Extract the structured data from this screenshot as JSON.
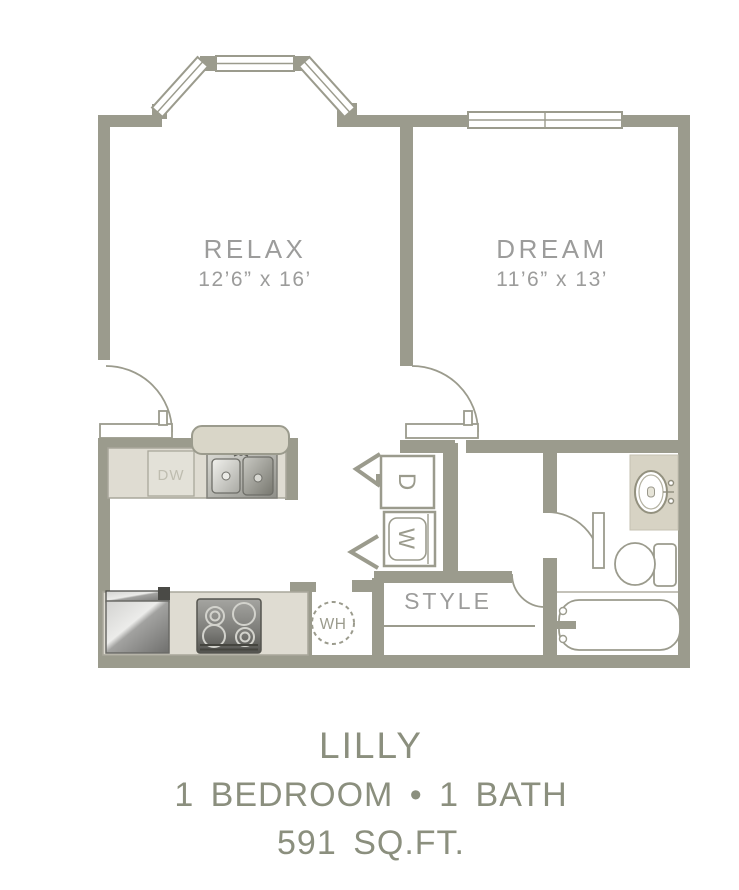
{
  "colors": {
    "wall": "#9B9B8D",
    "counterFill": "#DFDCD2",
    "counterStroke": "#A9A79B",
    "barFill": "#D9D6C8",
    "dwFill": "#E3E1D8",
    "dwText": "#BFBDB0",
    "vanityFill": "#D7D3C4",
    "labelGray": "#9C9C9B",
    "titleColor": "#8B8F7E"
  },
  "rooms": {
    "living": {
      "label": "RELAX",
      "dims": "12’6” x 16’"
    },
    "bedroom": {
      "label": "DREAM",
      "dims": "11’6” x 13’"
    }
  },
  "labels": {
    "closet": "STYLE",
    "water_heater": "WH",
    "dryer": "D",
    "washer": "W",
    "dishwasher": "DW"
  },
  "title": {
    "name": "LILLY",
    "beds_baths": "1 BEDROOM • 1 BATH",
    "area": "591 SQ.FT."
  }
}
